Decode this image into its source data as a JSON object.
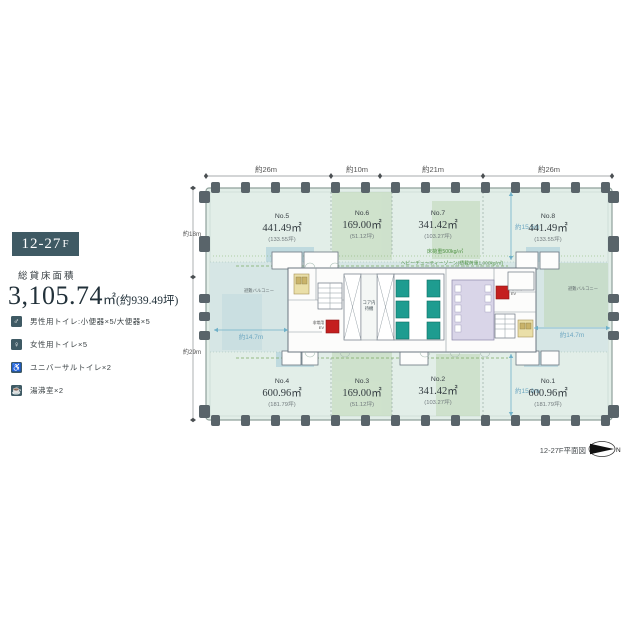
{
  "colors": {
    "badge": "#3f5a64",
    "plate": "#e2eee8",
    "band": "#d6e6e5",
    "green_zone": "#b8d3ab",
    "blue_zone": "#a8cdd8",
    "elevator": "#1e9c90",
    "alert_red": "#c41f1f",
    "restroom": "#d9d5e8",
    "kitchenette": "#eadfa8",
    "dim_blue": "#6fa8c2",
    "note_green": "#4d9040"
  },
  "panel": {
    "floor_badge": "12-27",
    "floor_badge_suffix": "F",
    "total_area_label": "総貸床面積",
    "total_area_value": "3,105.74",
    "total_area_unit": "㎡",
    "total_area_tsubo": "(約939.49坪)",
    "facilities": [
      {
        "glyph": "♂",
        "label": "男性用トイレ:小便器×5/大便器×5"
      },
      {
        "glyph": "♀",
        "label": "女性用トイレ×5"
      },
      {
        "glyph": "♿",
        "label": "ユニバーサルトイレ×2"
      },
      {
        "glyph": "☕",
        "label": "湯沸室×2"
      }
    ]
  },
  "plan": {
    "caption": "12-27F平面図",
    "north": "N",
    "dims_top": [
      "約26m",
      "約10m",
      "約21m",
      "約26m"
    ],
    "dim_left_top": "約18m",
    "dim_left_bottom": "約29m",
    "span_top": "約15.5m",
    "span_bottom": "約15.9m",
    "span_left": "約14.7m",
    "span_right": "約14.7m",
    "floor_load_note": "床荷重500kg/㎡",
    "heavy_duty_note": "ヘビーデューティーゾーン(積載荷重1,000kg/㎡)",
    "core_label_line1": "コア内",
    "core_label_line2": "待機",
    "ev_label_line1": "非常用",
    "ev_label_line2": "EV",
    "balcony_label": "避難バルコニー",
    "zones": [
      {
        "no": "No.5",
        "area": "441.49㎡",
        "tsubo": "(133.55坪)"
      },
      {
        "no": "No.6",
        "area": "169.00㎡",
        "tsubo": "(51.12坪)"
      },
      {
        "no": "No.7",
        "area": "341.42㎡",
        "tsubo": "(103.27坪)"
      },
      {
        "no": "No.8",
        "area": "441.49㎡",
        "tsubo": "(133.55坪)"
      },
      {
        "no": "No.4",
        "area": "600.96㎡",
        "tsubo": "(181.79坪)"
      },
      {
        "no": "No.3",
        "area": "169.00㎡",
        "tsubo": "(51.12坪)"
      },
      {
        "no": "No.2",
        "area": "341.42㎡",
        "tsubo": "(103.27坪)"
      },
      {
        "no": "No.1",
        "area": "600.96㎡",
        "tsubo": "(181.79坪)"
      }
    ]
  }
}
